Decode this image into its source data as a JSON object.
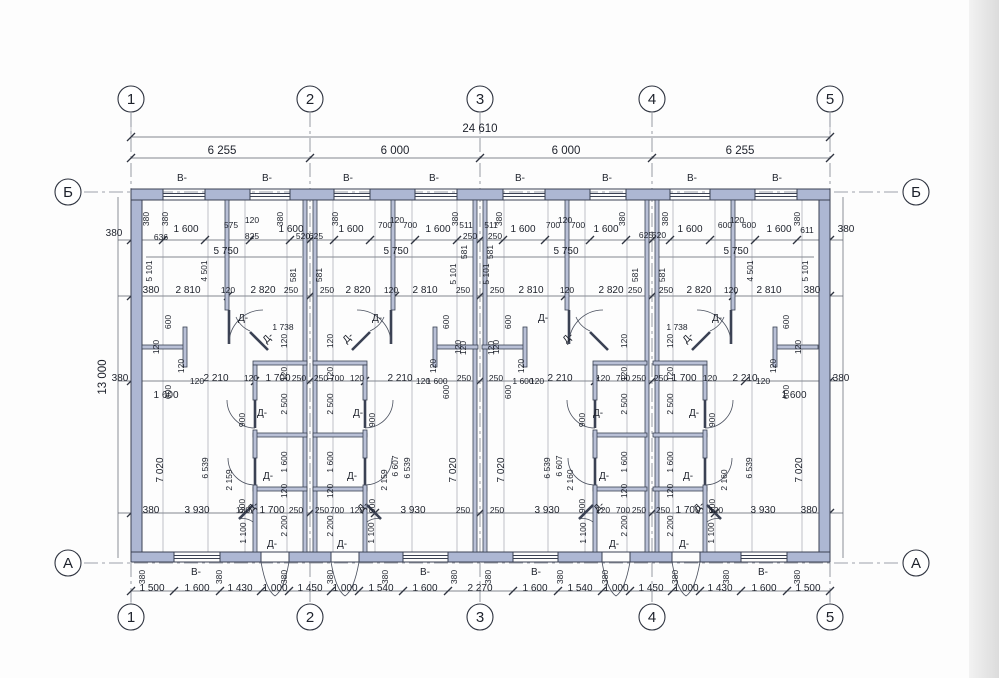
{
  "meta": {
    "drawing_type": "floor-plan",
    "units_label": "mm"
  },
  "colors": {
    "wall_fill": "#adb7d3",
    "wall_stroke": "#3a4153",
    "dim_line": "#5a5f6b",
    "background": "#fdfdfd"
  },
  "legend": {
    "window_mark": "В-",
    "door_mark": "Д-"
  },
  "overall_dimensions": {
    "total_width": "24 610",
    "bays": [
      "6 255",
      "6 000",
      "6 000",
      "6 255"
    ],
    "total_height": "13 000",
    "wall_thickness": "380"
  },
  "bottom_chain": [
    "1 500",
    "1 600",
    "1 430",
    "1 000",
    "1 450",
    "1 000",
    "1 540",
    "1 600",
    "2 270",
    "1 600",
    "1 540",
    "1 000",
    "1 450",
    "1 000",
    "1 430",
    "1 600",
    "1 500"
  ],
  "axis_grid": {
    "vertical": [
      {
        "label": "1",
        "x": 131
      },
      {
        "label": "2",
        "x": 310
      },
      {
        "label": "3",
        "x": 480
      },
      {
        "label": "4",
        "x": 652
      },
      {
        "label": "5",
        "x": 830
      }
    ],
    "vertical_y_top": 99,
    "vertical_y_bottom": 617,
    "horizontal": [
      {
        "label": "Б",
        "y": 192
      },
      {
        "label": "А",
        "y": 563
      }
    ],
    "horizontal_x_left": 68,
    "horizontal_x_right": 916,
    "radius": 13
  },
  "annotations": [
    [
      "24 610",
      480,
      132,
      0,
      "l"
    ],
    [
      "6 255",
      222,
      154,
      0,
      "l"
    ],
    [
      "6 000",
      395,
      154,
      0,
      "l"
    ],
    [
      "6 000",
      566,
      154,
      0,
      "l"
    ],
    [
      "6 255",
      740,
      154,
      0,
      "l"
    ],
    [
      "13 000",
      106,
      377,
      -90,
      "l"
    ],
    [
      "В-",
      182,
      181,
      0,
      "m"
    ],
    [
      "В-",
      267,
      181,
      0,
      "m"
    ],
    [
      "В-",
      348,
      181,
      0,
      "m"
    ],
    [
      "В-",
      434,
      181,
      0,
      "m"
    ],
    [
      "В-",
      520,
      181,
      0,
      "m"
    ],
    [
      "В-",
      607,
      181,
      0,
      "m"
    ],
    [
      "В-",
      692,
      181,
      0,
      "m"
    ],
    [
      "В-",
      777,
      181,
      0,
      "m"
    ],
    [
      "380",
      114,
      236,
      0,
      "m"
    ],
    [
      "636",
      161,
      240,
      0,
      "s"
    ],
    [
      "1 600",
      186,
      232,
      0,
      "m"
    ],
    [
      "575",
      231,
      228,
      0,
      "s"
    ],
    [
      "120",
      252,
      223,
      0,
      "s"
    ],
    [
      "825",
      252,
      239,
      0,
      "s"
    ],
    [
      "1 600",
      291,
      232,
      0,
      "m"
    ],
    [
      "520",
      303,
      239,
      0,
      "s"
    ],
    [
      "625",
      316,
      239,
      0,
      "s"
    ],
    [
      "1 600",
      351,
      232,
      0,
      "m"
    ],
    [
      "700",
      385,
      228,
      0,
      "s"
    ],
    [
      "120",
      397,
      223,
      0,
      "s"
    ],
    [
      "700",
      410,
      228,
      0,
      "s"
    ],
    [
      "1 600",
      438,
      232,
      0,
      "m"
    ],
    [
      "511",
      466,
      228,
      0,
      "s"
    ],
    [
      "250",
      470,
      239,
      0,
      "s"
    ],
    [
      "511",
      491,
      228,
      0,
      "s"
    ],
    [
      "250",
      495,
      239,
      0,
      "s"
    ],
    [
      "1 600",
      523,
      232,
      0,
      "m"
    ],
    [
      "700",
      553,
      228,
      0,
      "s"
    ],
    [
      "120",
      565,
      223,
      0,
      "s"
    ],
    [
      "700",
      578,
      228,
      0,
      "s"
    ],
    [
      "1 600",
      606,
      232,
      0,
      "m"
    ],
    [
      "625",
      646,
      238,
      0,
      "s"
    ],
    [
      "520",
      659,
      238,
      0,
      "s"
    ],
    [
      "1 600",
      690,
      232,
      0,
      "m"
    ],
    [
      "600",
      725,
      228,
      0,
      "s"
    ],
    [
      "120",
      737,
      223,
      0,
      "s"
    ],
    [
      "600",
      749,
      228,
      0,
      "s"
    ],
    [
      "1 600",
      779,
      232,
      0,
      "m"
    ],
    [
      "611",
      807,
      233,
      0,
      "s"
    ],
    [
      "380",
      846,
      232,
      0,
      "m"
    ],
    [
      "380",
      149,
      219,
      -90,
      "s"
    ],
    [
      "380",
      168,
      219,
      -90,
      "s"
    ],
    [
      "380",
      283,
      219,
      -90,
      "s"
    ],
    [
      "380",
      338,
      219,
      -90,
      "s"
    ],
    [
      "380",
      458,
      219,
      -90,
      "s"
    ],
    [
      "380",
      502,
      219,
      -90,
      "s"
    ],
    [
      "380",
      625,
      219,
      -90,
      "s"
    ],
    [
      "380",
      668,
      219,
      -90,
      "s"
    ],
    [
      "380",
      800,
      219,
      -90,
      "s"
    ],
    [
      "5 750",
      226,
      254,
      0,
      "m"
    ],
    [
      "5 750",
      396,
      254,
      0,
      "m"
    ],
    [
      "5 750",
      566,
      254,
      0,
      "m"
    ],
    [
      "5 750",
      736,
      254,
      0,
      "m"
    ],
    [
      "4 501",
      207,
      271,
      -90,
      "s"
    ],
    [
      "4 501",
      753,
      271,
      -90,
      "s"
    ],
    [
      "5 101",
      152,
      271,
      -90,
      "s"
    ],
    [
      "5 101",
      456,
      274,
      -90,
      "s"
    ],
    [
      "5 101",
      489,
      274,
      -90,
      "s"
    ],
    [
      "5 101",
      808,
      271,
      -90,
      "s"
    ],
    [
      "581",
      296,
      275,
      -90,
      "s"
    ],
    [
      "581",
      322,
      275,
      -90,
      "s"
    ],
    [
      "581",
      467,
      252,
      -90,
      "s"
    ],
    [
      "581",
      493,
      252,
      -90,
      "s"
    ],
    [
      "581",
      638,
      275,
      -90,
      "s"
    ],
    [
      "581",
      665,
      275,
      -90,
      "s"
    ],
    [
      "380",
      151,
      293,
      0,
      "m"
    ],
    [
      "2 810",
      188,
      293,
      0,
      "m"
    ],
    [
      "120",
      228,
      293,
      0,
      "s"
    ],
    [
      "2 820",
      263,
      293,
      0,
      "m"
    ],
    [
      "250",
      291,
      293,
      0,
      "s"
    ],
    [
      "250",
      327,
      293,
      0,
      "s"
    ],
    [
      "2 820",
      358,
      293,
      0,
      "m"
    ],
    [
      "120",
      391,
      293,
      0,
      "s"
    ],
    [
      "2 810",
      425,
      293,
      0,
      "m"
    ],
    [
      "250",
      463,
      293,
      0,
      "s"
    ],
    [
      "250",
      497,
      293,
      0,
      "s"
    ],
    [
      "2 810",
      531,
      293,
      0,
      "m"
    ],
    [
      "120",
      567,
      293,
      0,
      "s"
    ],
    [
      "2 820",
      611,
      293,
      0,
      "m"
    ],
    [
      "250",
      635,
      293,
      0,
      "s"
    ],
    [
      "250",
      666,
      293,
      0,
      "s"
    ],
    [
      "2 820",
      699,
      293,
      0,
      "m"
    ],
    [
      "120",
      731,
      293,
      0,
      "s"
    ],
    [
      "2 810",
      769,
      293,
      0,
      "m"
    ],
    [
      "380",
      812,
      293,
      0,
      "m"
    ],
    [
      "600",
      171,
      322,
      -90,
      "s"
    ],
    [
      "600",
      449,
      322,
      -90,
      "s"
    ],
    [
      "600",
      511,
      322,
      -90,
      "s"
    ],
    [
      "600",
      789,
      322,
      -90,
      "s"
    ],
    [
      "120",
      159,
      347,
      -90,
      "s"
    ],
    [
      "120",
      461,
      347,
      -90,
      "s"
    ],
    [
      "120",
      499,
      347,
      -90,
      "s"
    ],
    [
      "120",
      801,
      347,
      -90,
      "s"
    ],
    [
      "120",
      184,
      366,
      -90,
      "s"
    ],
    [
      "120",
      436,
      366,
      -90,
      "s"
    ],
    [
      "120",
      524,
      366,
      -90,
      "s"
    ],
    [
      "120",
      776,
      366,
      -90,
      "s"
    ],
    [
      "600",
      171,
      392,
      -90,
      "s"
    ],
    [
      "600",
      449,
      392,
      -90,
      "s"
    ],
    [
      "600",
      511,
      392,
      -90,
      "s"
    ],
    [
      "600",
      789,
      392,
      -90,
      "s"
    ],
    [
      "120",
      197,
      384,
      0,
      "s"
    ],
    [
      "120",
      423,
      384,
      0,
      "s"
    ],
    [
      "120",
      537,
      384,
      0,
      "s"
    ],
    [
      "120",
      763,
      384,
      0,
      "s"
    ],
    [
      "120",
      287,
      341,
      -90,
      "s"
    ],
    [
      "120",
      333,
      341,
      -90,
      "s"
    ],
    [
      "120",
      627,
      341,
      -90,
      "s"
    ],
    [
      "120",
      673,
      341,
      -90,
      "s"
    ],
    [
      "120",
      466,
      348,
      -90,
      "s"
    ],
    [
      "120",
      494,
      348,
      -90,
      "s"
    ],
    [
      "1 738",
      283,
      330,
      0,
      "s"
    ],
    [
      "1 738",
      677,
      330,
      0,
      "s"
    ],
    [
      "Д-",
      243,
      321,
      0,
      "m"
    ],
    [
      "Д-",
      377,
      321,
      0,
      "m"
    ],
    [
      "Д-",
      543,
      321,
      0,
      "m"
    ],
    [
      "Д-",
      717,
      321,
      0,
      "m"
    ],
    [
      "Д-",
      270,
      340,
      -45,
      "m"
    ],
    [
      "Д-",
      350,
      340,
      -45,
      "m"
    ],
    [
      "Д-",
      570,
      340,
      -45,
      "m"
    ],
    [
      "Д-",
      690,
      340,
      -45,
      "m"
    ],
    [
      "380",
      120,
      381,
      0,
      "m"
    ],
    [
      "2 210",
      216,
      381,
      0,
      "m"
    ],
    [
      "120",
      251,
      381,
      0,
      "s"
    ],
    [
      "1 700",
      278,
      381,
      0,
      "m"
    ],
    [
      "250",
      299,
      381,
      0,
      "s"
    ],
    [
      "250",
      321,
      381,
      0,
      "s"
    ],
    [
      "700",
      337,
      381,
      0,
      "s"
    ],
    [
      "120",
      357,
      381,
      0,
      "s"
    ],
    [
      "2 210",
      400,
      381,
      0,
      "m"
    ],
    [
      "1 600",
      437,
      384,
      0,
      "s"
    ],
    [
      "250",
      464,
      381,
      0,
      "s"
    ],
    [
      "250",
      496,
      381,
      0,
      "s"
    ],
    [
      "1 600",
      523,
      384,
      0,
      "s"
    ],
    [
      "2 210",
      560,
      381,
      0,
      "m"
    ],
    [
      "120",
      603,
      381,
      0,
      "s"
    ],
    [
      "700",
      623,
      381,
      0,
      "s"
    ],
    [
      "250",
      639,
      381,
      0,
      "s"
    ],
    [
      "250",
      661,
      381,
      0,
      "s"
    ],
    [
      "1 700",
      684,
      381,
      0,
      "m"
    ],
    [
      "120",
      710,
      381,
      0,
      "s"
    ],
    [
      "2 210",
      745,
      381,
      0,
      "m"
    ],
    [
      "380",
      841,
      381,
      0,
      "m"
    ],
    [
      "1 600",
      166,
      398,
      0,
      "m"
    ],
    [
      "1 600",
      794,
      398,
      0,
      "m"
    ],
    [
      "120",
      287,
      374,
      -90,
      "s"
    ],
    [
      "2 500",
      287,
      404,
      -90,
      "s"
    ],
    [
      "1 600",
      287,
      462,
      -90,
      "s"
    ],
    [
      "120",
      287,
      491,
      -90,
      "s"
    ],
    [
      "2 200",
      287,
      526,
      -90,
      "s"
    ],
    [
      "120",
      333,
      374,
      -90,
      "s"
    ],
    [
      "2 500",
      333,
      404,
      -90,
      "s"
    ],
    [
      "1 600",
      333,
      462,
      -90,
      "s"
    ],
    [
      "120",
      333,
      491,
      -90,
      "s"
    ],
    [
      "2 200",
      333,
      526,
      -90,
      "s"
    ],
    [
      "120",
      627,
      374,
      -90,
      "s"
    ],
    [
      "2 500",
      627,
      404,
      -90,
      "s"
    ],
    [
      "1 600",
      627,
      462,
      -90,
      "s"
    ],
    [
      "120",
      627,
      491,
      -90,
      "s"
    ],
    [
      "2 200",
      627,
      526,
      -90,
      "s"
    ],
    [
      "120",
      673,
      374,
      -90,
      "s"
    ],
    [
      "2 500",
      673,
      404,
      -90,
      "s"
    ],
    [
      "1 600",
      673,
      462,
      -90,
      "s"
    ],
    [
      "120",
      673,
      491,
      -90,
      "s"
    ],
    [
      "2 200",
      673,
      526,
      -90,
      "s"
    ],
    [
      "7 020",
      163,
      470,
      -90,
      "m"
    ],
    [
      "7 020",
      456,
      470,
      -90,
      "m"
    ],
    [
      "7 020",
      504,
      470,
      -90,
      "m"
    ],
    [
      "7 020",
      802,
      470,
      -90,
      "m"
    ],
    [
      "6 539",
      208,
      468,
      -90,
      "s"
    ],
    [
      "6 539",
      410,
      468,
      -90,
      "s"
    ],
    [
      "6 539",
      550,
      468,
      -90,
      "s"
    ],
    [
      "6 539",
      752,
      468,
      -90,
      "s"
    ],
    [
      "2 159",
      232,
      480,
      -90,
      "s"
    ],
    [
      "2 159",
      387,
      480,
      -90,
      "s"
    ],
    [
      "2 160",
      573,
      480,
      -90,
      "s"
    ],
    [
      "2 160",
      727,
      480,
      -90,
      "s"
    ],
    [
      "6 607",
      398,
      466,
      -90,
      "s"
    ],
    [
      "6 607",
      562,
      466,
      -90,
      "s"
    ],
    [
      "900",
      245,
      420,
      -90,
      "s"
    ],
    [
      "900",
      245,
      506,
      -90,
      "s"
    ],
    [
      "900",
      375,
      420,
      -90,
      "s"
    ],
    [
      "900",
      375,
      506,
      -90,
      "s"
    ],
    [
      "900",
      585,
      420,
      -90,
      "s"
    ],
    [
      "900",
      585,
      506,
      -90,
      "s"
    ],
    [
      "900",
      715,
      420,
      -90,
      "s"
    ],
    [
      "900",
      715,
      506,
      -90,
      "s"
    ],
    [
      "1 100",
      246,
      533,
      -90,
      "s"
    ],
    [
      "1 100",
      374,
      533,
      -90,
      "s"
    ],
    [
      "1 100",
      586,
      533,
      -90,
      "s"
    ],
    [
      "1 100",
      714,
      533,
      -90,
      "s"
    ],
    [
      "Д-",
      262,
      416,
      0,
      "m"
    ],
    [
      "Д-",
      268,
      479,
      0,
      "m"
    ],
    [
      "Д-",
      358,
      416,
      0,
      "m"
    ],
    [
      "Д-",
      352,
      479,
      0,
      "m"
    ],
    [
      "Д-",
      598,
      416,
      0,
      "m"
    ],
    [
      "Д-",
      604,
      479,
      0,
      "m"
    ],
    [
      "Д-",
      694,
      416,
      0,
      "m"
    ],
    [
      "Д-",
      688,
      479,
      0,
      "m"
    ],
    [
      "Д-",
      255,
      509,
      -45,
      "m"
    ],
    [
      "Д-",
      365,
      509,
      -45,
      "m"
    ],
    [
      "Д-",
      601,
      509,
      -45,
      "m"
    ],
    [
      "Д-",
      701,
      509,
      -45,
      "m"
    ],
    [
      "Д-",
      272,
      547,
      0,
      "m"
    ],
    [
      "Д-",
      342,
      547,
      0,
      "m"
    ],
    [
      "Д-",
      614,
      547,
      0,
      "m"
    ],
    [
      "Д-",
      684,
      547,
      0,
      "m"
    ],
    [
      "380",
      151,
      513,
      0,
      "m"
    ],
    [
      "3 930",
      197,
      513,
      0,
      "m"
    ],
    [
      "120",
      243,
      513,
      0,
      "s"
    ],
    [
      "1 700",
      272,
      513,
      0,
      "m"
    ],
    [
      "250",
      296,
      513,
      0,
      "s"
    ],
    [
      "250",
      322,
      513,
      0,
      "s"
    ],
    [
      "700",
      337,
      513,
      0,
      "s"
    ],
    [
      "120",
      357,
      513,
      0,
      "s"
    ],
    [
      "3 930",
      413,
      513,
      0,
      "m"
    ],
    [
      "250",
      463,
      513,
      0,
      "s"
    ],
    [
      "250",
      497,
      513,
      0,
      "s"
    ],
    [
      "3 930",
      547,
      513,
      0,
      "m"
    ],
    [
      "120",
      603,
      513,
      0,
      "s"
    ],
    [
      "700",
      623,
      513,
      0,
      "s"
    ],
    [
      "250",
      639,
      513,
      0,
      "s"
    ],
    [
      "250",
      663,
      513,
      0,
      "s"
    ],
    [
      "1 700",
      688,
      513,
      0,
      "m"
    ],
    [
      "120",
      716,
      513,
      0,
      "s"
    ],
    [
      "3 930",
      763,
      513,
      0,
      "m"
    ],
    [
      "380",
      809,
      513,
      0,
      "m"
    ],
    [
      "380",
      145,
      577,
      -90,
      "s"
    ],
    [
      "380",
      222,
      577,
      -90,
      "s"
    ],
    [
      "380",
      287,
      577,
      -90,
      "s"
    ],
    [
      "380",
      333,
      577,
      -90,
      "s"
    ],
    [
      "380",
      388,
      577,
      -90,
      "s"
    ],
    [
      "380",
      457,
      577,
      -90,
      "s"
    ],
    [
      "380",
      491,
      577,
      -90,
      "s"
    ],
    [
      "380",
      563,
      577,
      -90,
      "s"
    ],
    [
      "380",
      608,
      577,
      -90,
      "s"
    ],
    [
      "380",
      678,
      577,
      -90,
      "s"
    ],
    [
      "380",
      729,
      577,
      -90,
      "s"
    ],
    [
      "380",
      800,
      577,
      -90,
      "s"
    ],
    [
      "В-",
      196,
      575,
      0,
      "m"
    ],
    [
      "В-",
      425,
      575,
      0,
      "m"
    ],
    [
      "В-",
      536,
      575,
      0,
      "m"
    ],
    [
      "В-",
      763,
      575,
      0,
      "m"
    ],
    [
      "1 500",
      152,
      591,
      0,
      "m"
    ],
    [
      "1 600",
      197,
      591,
      0,
      "m"
    ],
    [
      "1 430",
      240,
      591,
      0,
      "m"
    ],
    [
      "1 000",
      275,
      591,
      0,
      "m"
    ],
    [
      "1 450",
      310,
      591,
      0,
      "m"
    ],
    [
      "1 000",
      345,
      591,
      0,
      "m"
    ],
    [
      "1 540",
      381,
      591,
      0,
      "m"
    ],
    [
      "1 600",
      425,
      591,
      0,
      "m"
    ],
    [
      "2 270",
      480,
      591,
      0,
      "m"
    ],
    [
      "1 600",
      535,
      591,
      0,
      "m"
    ],
    [
      "1 540",
      580,
      591,
      0,
      "m"
    ],
    [
      "1 000",
      616,
      591,
      0,
      "m"
    ],
    [
      "1 450",
      651,
      591,
      0,
      "m"
    ],
    [
      "1 000",
      686,
      591,
      0,
      "m"
    ],
    [
      "1 430",
      720,
      591,
      0,
      "m"
    ],
    [
      "1 600",
      764,
      591,
      0,
      "m"
    ],
    [
      "1 500",
      808,
      591,
      0,
      "m"
    ]
  ]
}
